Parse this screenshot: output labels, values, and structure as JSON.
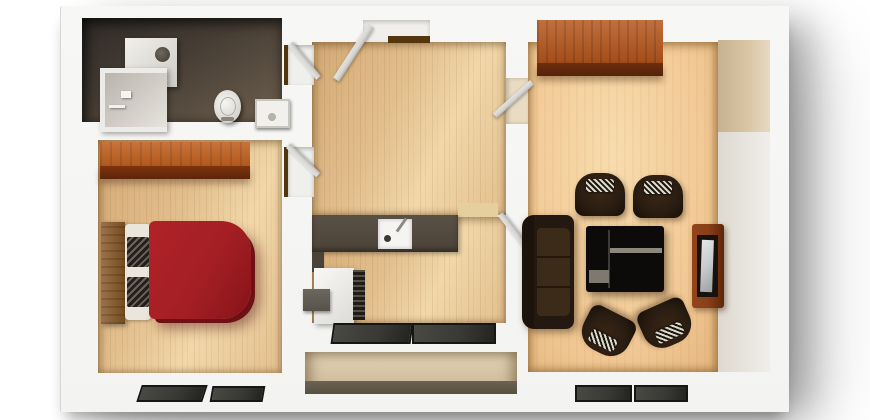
{
  "scene": {
    "type": "apartment-floor-plan-3d-top-view",
    "description": "3D rendered top-down floor plan of a one-bedroom apartment on a white background with drop shadow to the right and bottom",
    "rooms": [
      {
        "name": "bathroom",
        "floor": "dark-tile",
        "items": [
          "water-heater",
          "shower-cabin",
          "toilet",
          "wash-basin",
          "door-open"
        ]
      },
      {
        "name": "bedroom",
        "floor": "light-wood-plank",
        "items": [
          "wardrobe",
          "double-bed-red",
          "wood-headboard",
          "pillows-with-blankets",
          "window",
          "window",
          "door-open"
        ]
      },
      {
        "name": "hallway",
        "floor": "light-wood-plank",
        "items": [
          "entrance-door-open"
        ]
      },
      {
        "name": "kitchen",
        "floor": "light-wood-plank",
        "items": [
          "worktop-counter",
          "sink-with-faucet",
          "refrigerator",
          "radiator-grate",
          "side-unit",
          "window",
          "window",
          "door-open"
        ]
      },
      {
        "name": "living-room",
        "floor": "warm-wood",
        "items": [
          "sideboard",
          "sofa",
          "armchair",
          "armchair",
          "armchair",
          "armchair",
          "coffee-table",
          "tv-cabinet",
          "tv",
          "window",
          "window",
          "door-open"
        ]
      },
      {
        "name": "balcony-recess",
        "floor": "concrete",
        "items": []
      }
    ]
  },
  "colors": {
    "background": "#ffffff",
    "wall": "#f3f3f1",
    "wood-floor-base": "#e3bf8e",
    "wood-floor-light": "#f1d7a9",
    "wood-floor-dark": "#d2a974",
    "living-floor-base": "#f2ca96",
    "living-floor-light": "#f8dcae",
    "bath-floor-dark": "#2f2b27",
    "bath-floor-light": "#6e604f",
    "wardrobe-top": "#c06020",
    "wardrobe-front": "#7e340e",
    "cabinet-top": "#b5561c",
    "cabinet-front": "#6d2e0c",
    "bed-red": "#a31f24",
    "bed-red-dark": "#6e1014",
    "headboard-wood": "#8a5a28",
    "pillow-white": "#eae6dc",
    "blanket-dark": "#23201b",
    "sofa-brown": "#241911",
    "chair-brown": "#271b10",
    "cushion-light": "#ded8c8",
    "table-black": "#0d0b09",
    "table-accent": "#8d887d",
    "tv-stand-wood": "#8a3f18",
    "tv-screen": "#c6cacc",
    "counter-gray": "#4b4339",
    "appliance-white": "#f5f4f2",
    "appliance-gray": "#57524a",
    "window-glass": "#383834",
    "window-frame": "#161614",
    "niche-wall": "#d7c6a6",
    "niche-floor": "#57503f",
    "door-wood-dark": "#53350e",
    "door-leaf-gray": "#d7d6d2",
    "beige-wall": "#d9c5a4"
  }
}
